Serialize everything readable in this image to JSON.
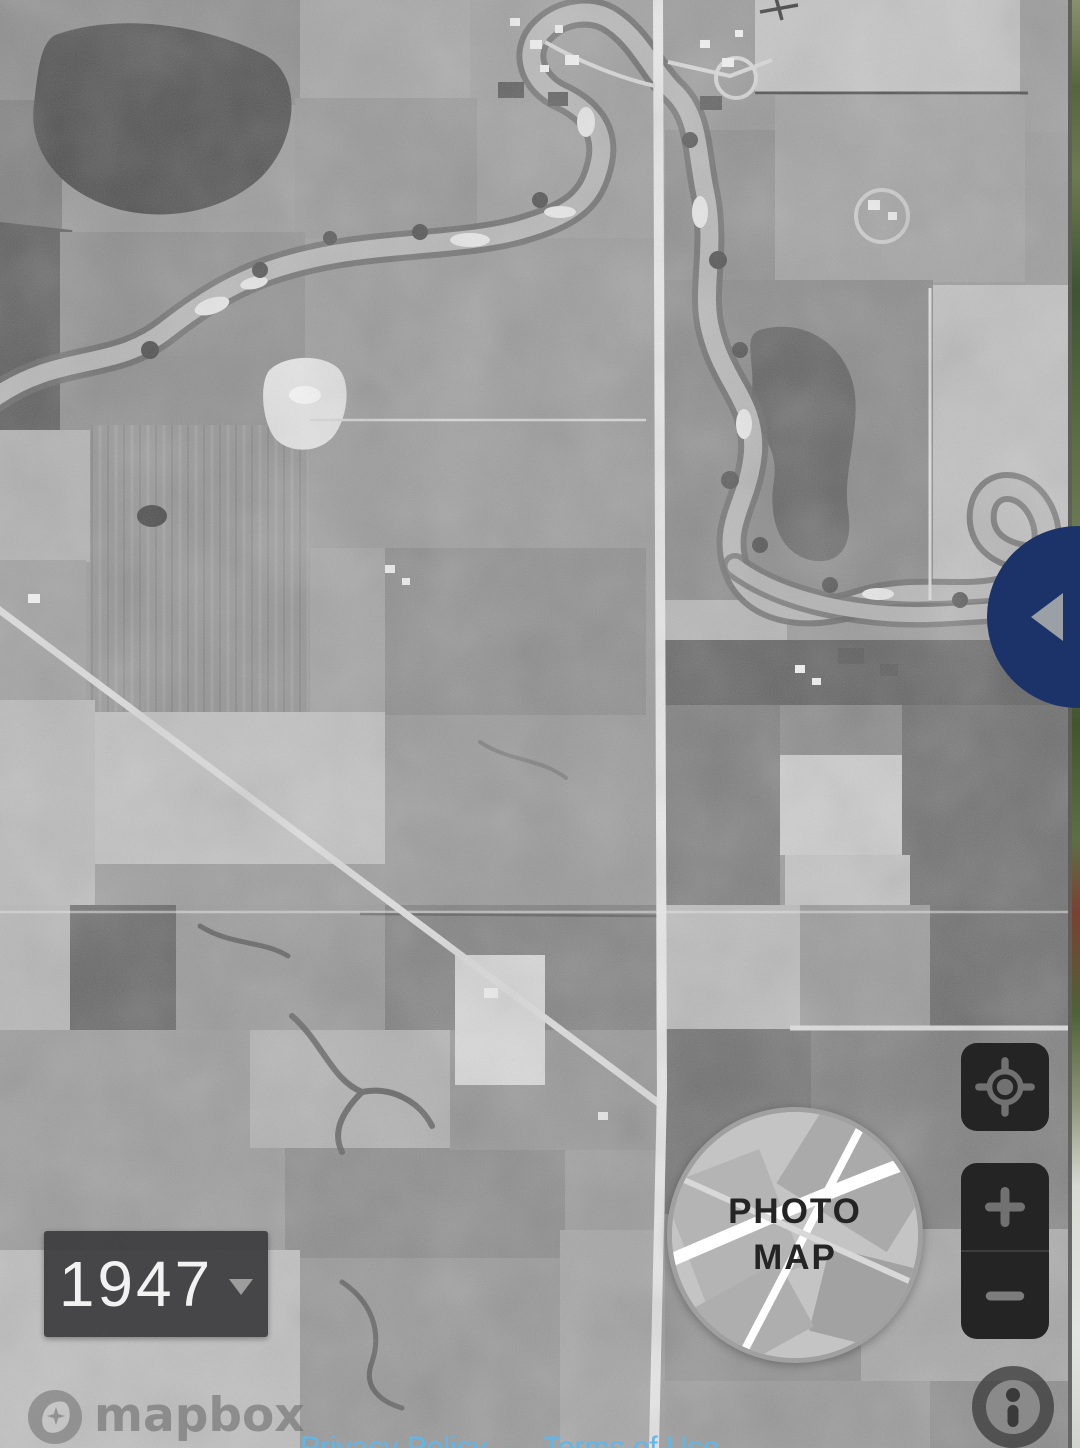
{
  "app": {
    "description": "Historical aerial photo map viewer showing a 1947 black-and-white aerial photograph with a swipe handle revealing a modern map layer at the right edge"
  },
  "year_selector": {
    "value": "1947",
    "caret_icon": "dropdown-caret"
  },
  "layer_toggle": {
    "line1": "PHOTO",
    "line2": "MAP"
  },
  "controls": {
    "locate_icon": "locate-target",
    "zoom_in_icon": "plus",
    "zoom_out_icon": "minus",
    "swipe_arrow_icon": "triangle-left"
  },
  "attribution": {
    "brand": "mapbox",
    "info_icon": "info-i"
  },
  "footer_links": {
    "privacy": "Privacy Policy",
    "terms": "Terms of Use"
  },
  "colors": {
    "accent_blue": "#1b3368",
    "control_bg": "#242424",
    "control_icon": "#717171",
    "link_blue": "#5fb7ea",
    "year_box_bg": "#3c3c3e",
    "photo_base_gray": "#9b9b9b"
  }
}
